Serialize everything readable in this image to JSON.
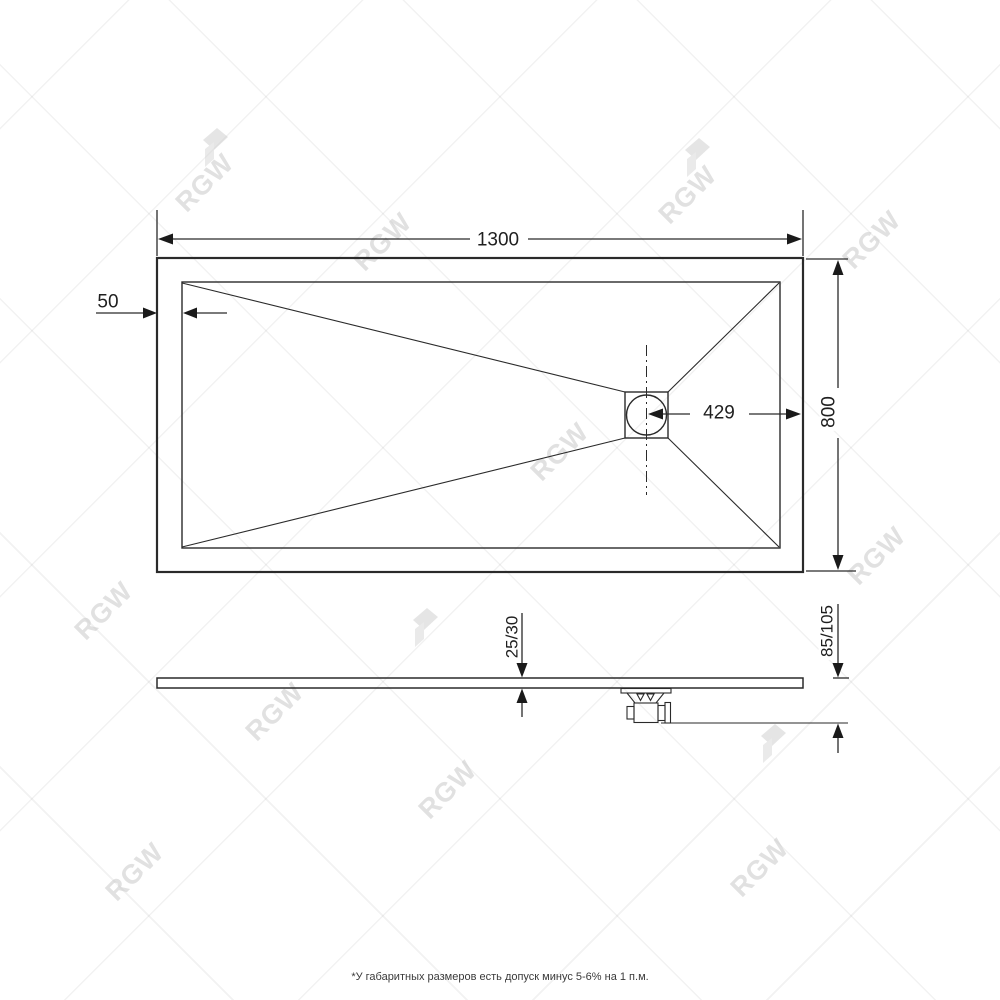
{
  "drawing": {
    "top_view": {
      "length_label": "1300",
      "border_offset_label": "50",
      "drain_to_edge_label": "429",
      "width_label": "800"
    },
    "side_view": {
      "tray_thickness_label": "25/30",
      "overall_height_label": "85/105"
    },
    "footnote": "*У габаритных размеров есть допуск минус  5-6% на 1 п.м.",
    "watermark": {
      "text": "RGW"
    },
    "colors": {
      "line": "#2a2a2a",
      "watermark_text": "#c9c9c9",
      "background": "#ffffff"
    }
  }
}
